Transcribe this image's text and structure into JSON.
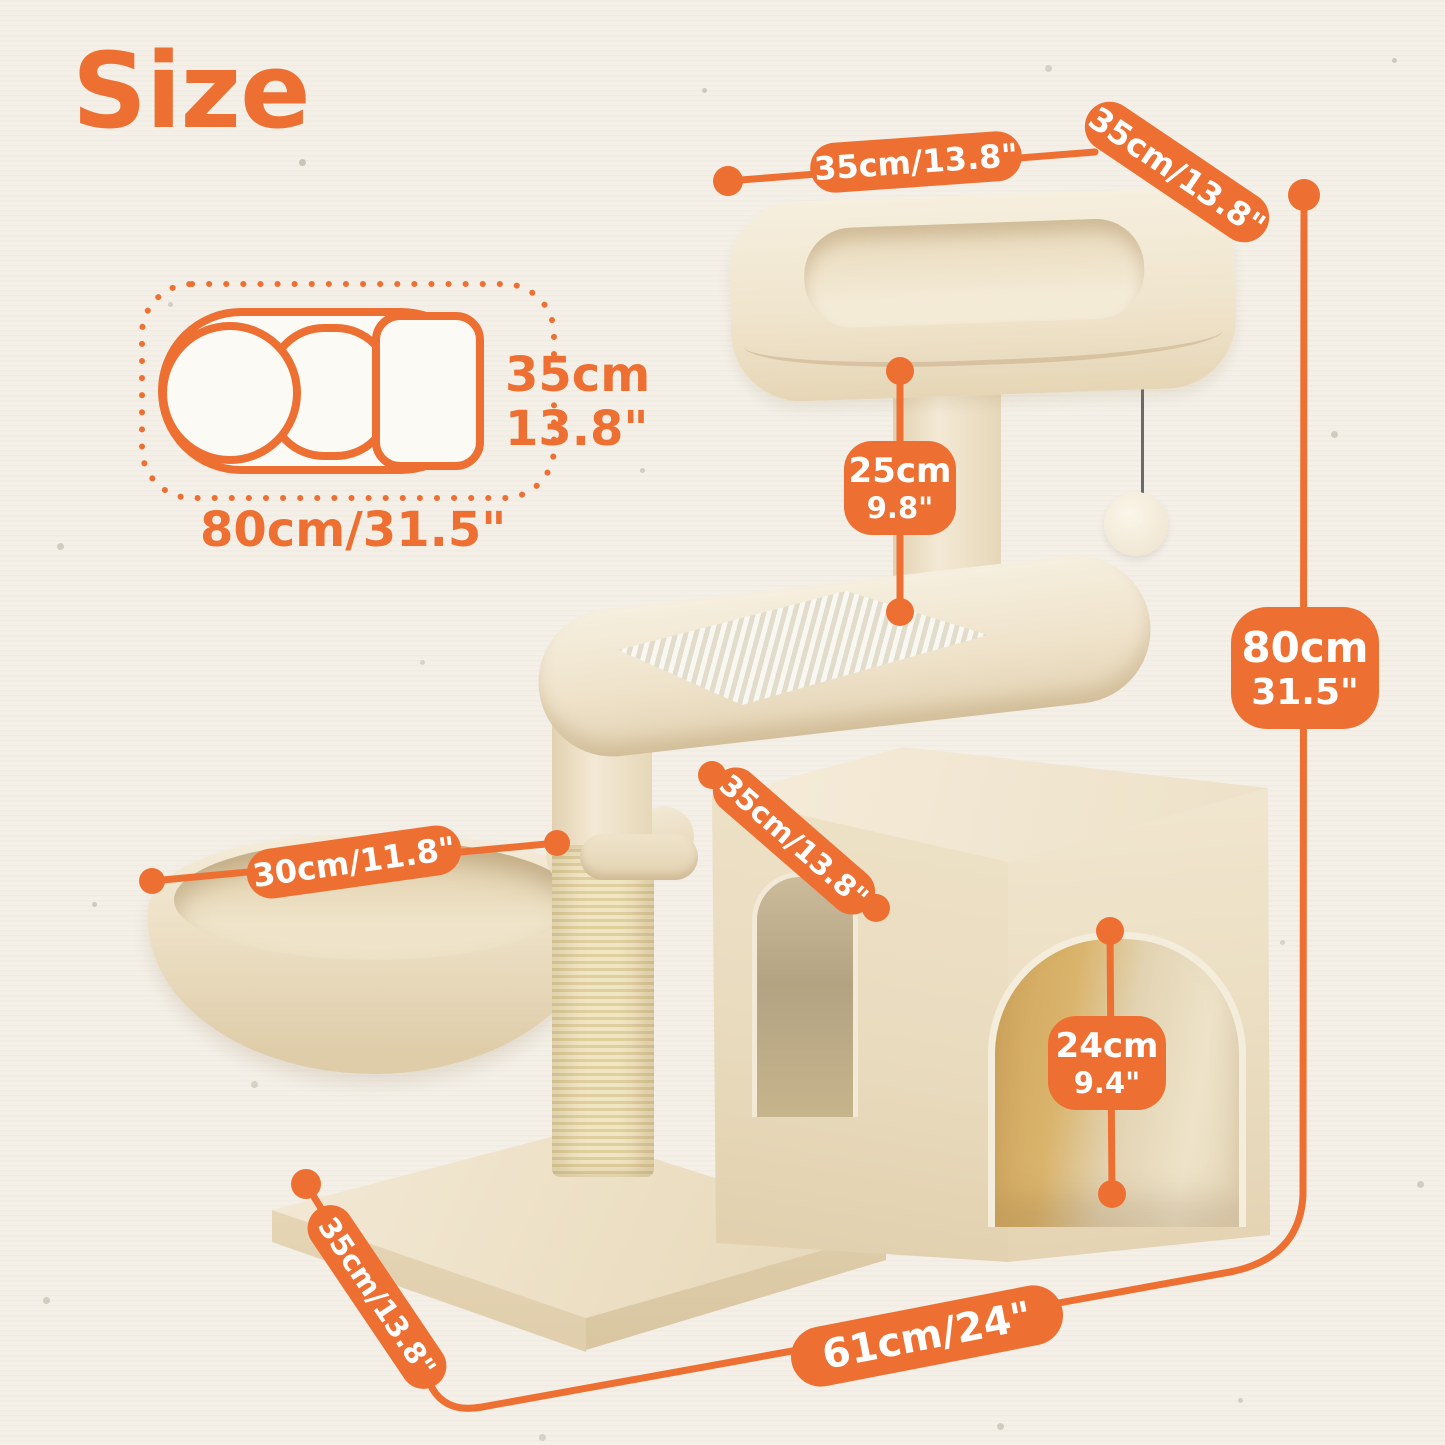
{
  "title": "Size",
  "colors": {
    "accent": "#ED7032",
    "background": "#F4F0E8",
    "plush": "#F0E4CC",
    "sisal": "#EDE0B4",
    "wood": "#D2A85F"
  },
  "footprint": {
    "depth_cm": "35cm",
    "depth_in": "13.8\"",
    "width": "80cm/31.5\""
  },
  "dims": {
    "perch_width": "35cm/13.8\"",
    "perch_depth": "35cm/13.8\"",
    "upper_post_cm": "25cm",
    "upper_post_in": "9.8\"",
    "height_cm": "80cm",
    "height_in": "31.5\"",
    "condo_width": "35cm/13.8\"",
    "basket_diameter": "30cm/11.8\"",
    "opening_cm": "24cm",
    "opening_in": "9.4\"",
    "base_depth": "35cm/13.8\"",
    "base_width": "61cm/24\""
  }
}
